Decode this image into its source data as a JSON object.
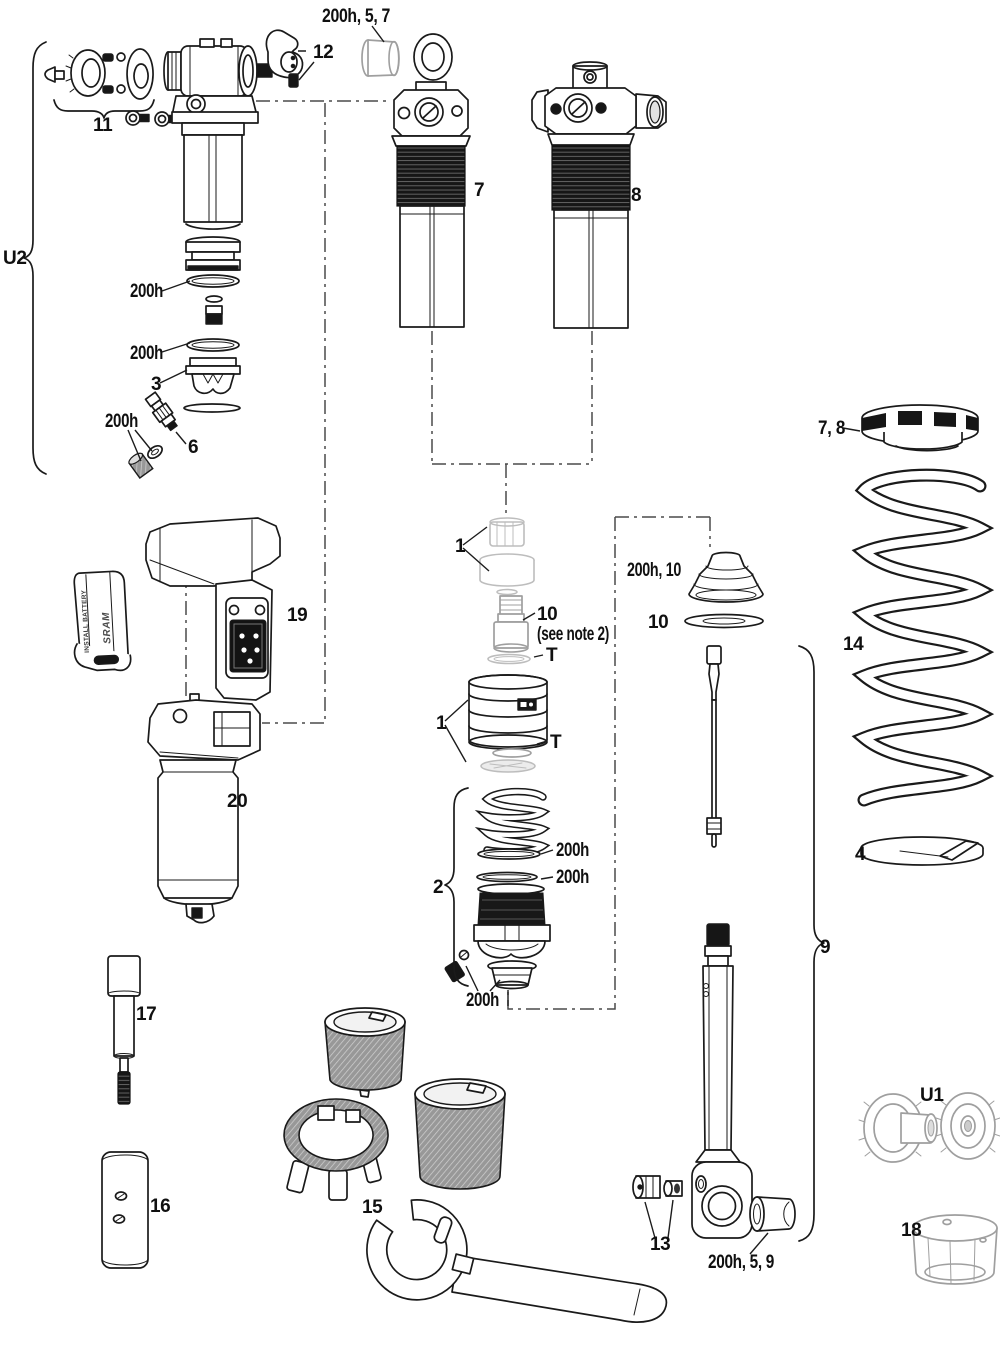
{
  "figure": {
    "colors": {
      "line": "#1a1a1a",
      "faded": "#bdbdbd",
      "threads": "#161616",
      "background": "#ffffff"
    }
  },
  "callouts": {
    "group_u2": "U2",
    "group_2": "2",
    "group_9": "9",
    "group_u1": "U1",
    "hw_11": "11",
    "lever_12": "12",
    "bushing_top": "200h, 5, 7",
    "shock_7": "7",
    "shock_8": "8",
    "oring_u2_upper": "200h",
    "oring_u2_lower": "200h",
    "piston_3": "3",
    "oring_valve": "200h",
    "valve_6": "6",
    "module_19": "19",
    "shock_20": "20",
    "cap_1": "1",
    "adjuster_10": "10",
    "adjuster_10_note": "(see note 2)",
    "seal_t_upper": "T",
    "body_1": "1",
    "seal_t_lower": "T",
    "bellows_200h_10": "200h, 10",
    "disc_10": "10",
    "oring_2_upper": "200h",
    "oring_2_lower": "200h",
    "oring_2_bottom": "200h",
    "collar_7_8": "7, 8",
    "spring_14": "14",
    "retainer_4": "4",
    "hw_13": "13",
    "bushing_bottom": "200h, 5, 9",
    "wrench_15": "15",
    "tool_16": "16",
    "tool_17": "17",
    "collar_18": "18"
  },
  "battery": {
    "line1": "INSTALL BATTERY",
    "brand": "SRAM"
  }
}
